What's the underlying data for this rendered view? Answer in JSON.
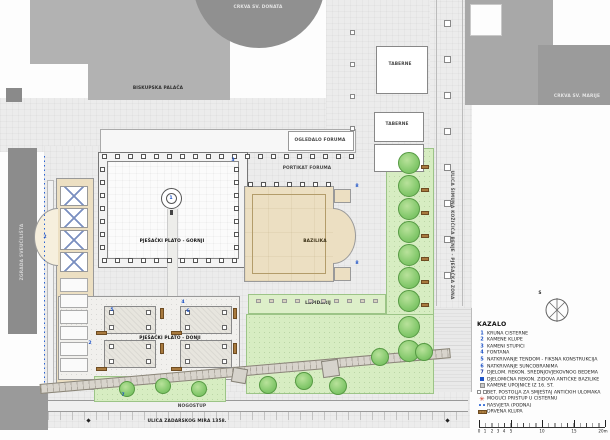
{
  "map": {
    "labels": {
      "crkva_sv_donata": "CRKVA SV. DONATA",
      "biskupska_palaca": "BISKUPSKA PALAČA",
      "crkva_sv_marije": "CRKVA SV. MARIJE",
      "taberne_a": "TABERNE",
      "taberne_b": "TABERNE",
      "ogledalo_foruma": "OGLEDALO FORUMA",
      "portikat_foruma": "PORTIKAT FORUMA",
      "plato_gornji": "PJEŠAČKI PLATO - GORNJI",
      "plato_donji": "PJEŠAČKI PLATO - DONJI",
      "bazilika": "BAZILIKA",
      "lapidarij": "LAPIDARIJ",
      "nogostup": "NOGOSTUP",
      "ulica_donja": "ULICA ZADARSKOG MIRA 1358.",
      "ulica_istocna": "ULICA ŠIMUNA KOŽIČIĆA BENJE - PJEŠAČKA ZONA",
      "zgrada_zapad": "ZGRADA SVEUČILIŠTA"
    },
    "plan_markers": [
      "1",
      "2",
      "3",
      "2",
      "4",
      "5",
      "6",
      "7",
      "8",
      "8"
    ]
  },
  "legend": {
    "title": "KAZALO",
    "compass_label": "S",
    "items": [
      {
        "marker": "1",
        "type": "num",
        "label": "KRUNA CISTERNE"
      },
      {
        "marker": "2",
        "type": "num",
        "label": "KAMENE KLUPE"
      },
      {
        "marker": "3",
        "type": "num",
        "label": "KAMENI STUPIĆI"
      },
      {
        "marker": "4",
        "type": "num",
        "label": "FONTANA"
      },
      {
        "marker": "5",
        "type": "num",
        "label": "NATKRIVANJE TENDOM - FIKSNA KONSTRUKCIJA"
      },
      {
        "marker": "6",
        "type": "num",
        "label": "NATKRIVANJE SUNCOBRANIMA"
      },
      {
        "marker": "7",
        "type": "num-bold",
        "label": "DJELOM. REKON. SREDNJOVJEKOVNOG BEDEMA"
      },
      {
        "marker": "8",
        "type": "square",
        "label": "DJELOMIČNA REKON. ZIDOVA ANTIČKE BAZILIKE"
      },
      {
        "marker": "",
        "type": "gray-square",
        "label": "KAMENE UPOJNICE IZ 16. ST."
      },
      {
        "marker": "",
        "type": "gray-pair",
        "label": "BET. POSTOLJA ZA SMJEŠTAJ ANTIČKIH ULOMAKA"
      },
      {
        "marker": "",
        "type": "red-star",
        "label": "MOGUĆI PRISTUP U CISTERNU"
      },
      {
        "marker": "",
        "type": "blue-dots",
        "label": "RASVJETA (PODNA)"
      },
      {
        "marker": "",
        "type": "wood-bar",
        "label": "DRVENA KLUPA"
      }
    ]
  },
  "scalebar": {
    "labels": [
      "0",
      "1",
      "2",
      "3",
      "4",
      "5",
      "10",
      "15",
      "20m"
    ]
  },
  "colors": {
    "accent_blue": "#1d52c6",
    "tree_green": "#7cc36a",
    "lawn_green": "#d7edc2",
    "stone_beige": "#ecdfc2",
    "building_gray": "#8f8f8f",
    "wood_brown": "#a87a3e",
    "mark_red": "#cc3322"
  }
}
